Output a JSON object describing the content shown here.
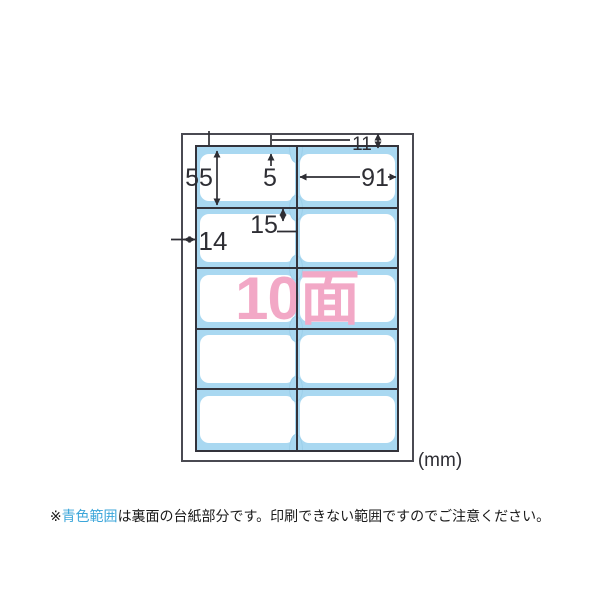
{
  "diagram": {
    "faces_label": "10面",
    "unit_label": "(mm)",
    "dimensions": {
      "label_height": "55",
      "edge_gap": "5",
      "label_width": "91",
      "notch_depth": "15",
      "side_margin": "14",
      "top_margin": "11"
    },
    "grid": {
      "rows": 5,
      "columns": 2,
      "total_labels": 10
    },
    "colors": {
      "backing_blue": "#A9D8F1",
      "accent_pink": "#F2A8C6",
      "caption_blue": "#3BA6DA",
      "line_dark": "#2E2E34"
    }
  },
  "caption": {
    "marker": "※",
    "highlight": "青色範囲",
    "rest": "は裏面の台紙部分です。印刷できない範囲ですのでご注意ください。"
  }
}
